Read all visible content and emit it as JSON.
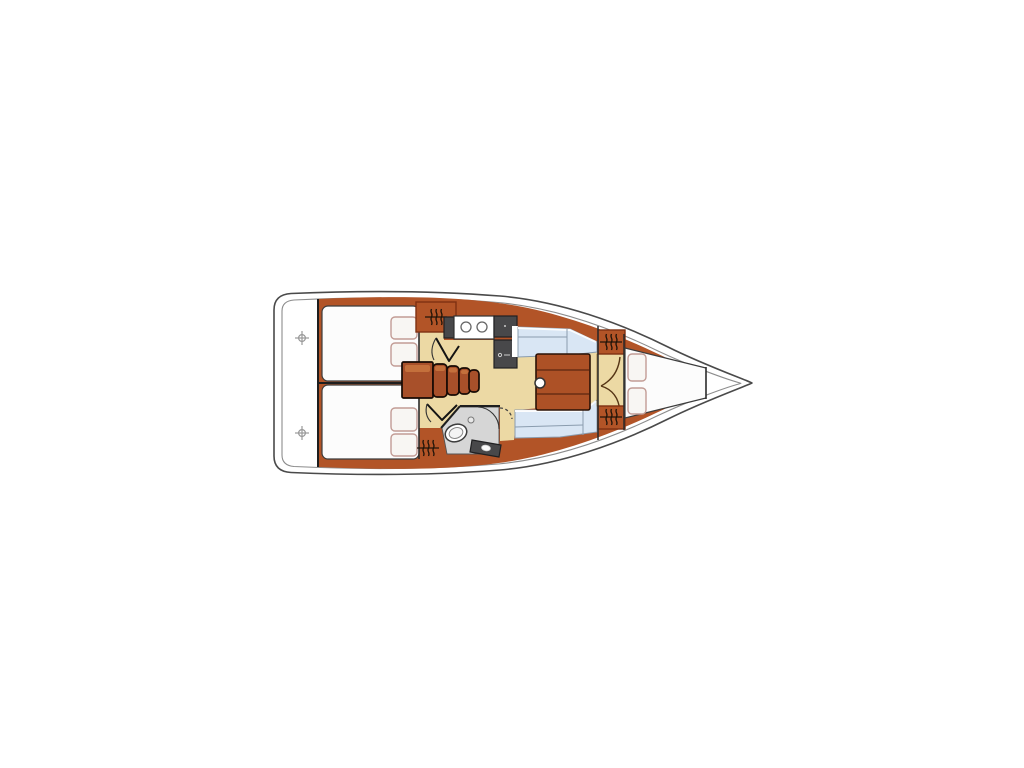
{
  "diagram": {
    "type": "sailboat-interior-floor-plan-top-view",
    "orientation": "bow-right-stern-left",
    "colors": {
      "background": "#ffffff",
      "hull_fill": "#ffffff",
      "hull_outline": "#4a4a4a",
      "hull_inner_line": "#8c8c8c",
      "furniture": "#b25427",
      "furniture_dark": "#7e3112",
      "furniture_light": "#c9753f",
      "steps": "#a8502a",
      "table": "#ad5126",
      "table_line": "#5c2710",
      "floor": "#ecd9a4",
      "settee": "#d9e6f4",
      "settee_line": "#8a9cae",
      "berth": "#fcfcfc",
      "berth_outline": "#3c3c3c",
      "pillow": "#f8f6f3",
      "pillow_outline": "#c29c95",
      "appliance": "#48484a",
      "appliance_dark": "#202022",
      "head_floor": "#d6d6d6",
      "wall_line": "#1e1e1e",
      "door_line": "#553415",
      "icon_gray": "#989898",
      "hanger_icon": "#22150a"
    },
    "areas": [
      "swim-platform-transom",
      "aft-cabin-port-double-berth",
      "aft-cabin-starboard-double-berth",
      "companionway-steps",
      "galley-double-sink-and-stove",
      "head-toilet-shower-vanity",
      "salon-port-settee",
      "salon-starboard-settee",
      "salon-table-with-mast-post",
      "forward-hanging-lockers",
      "forward-cabin-v-berth",
      "bow-anchor-locker"
    ],
    "icons": [
      {
        "name": "deck-fitting-crosshair-icon",
        "count": 2
      },
      {
        "name": "hanging-locker-rail-icon",
        "count": 4
      },
      {
        "name": "sink-basin-icon",
        "count": 2
      },
      {
        "name": "stove-burner-icon",
        "count": 1
      },
      {
        "name": "toilet-icon",
        "count": 1
      },
      {
        "name": "door-swing-icon",
        "count": 5
      },
      {
        "name": "mast-post-icon",
        "count": 1
      }
    ]
  }
}
